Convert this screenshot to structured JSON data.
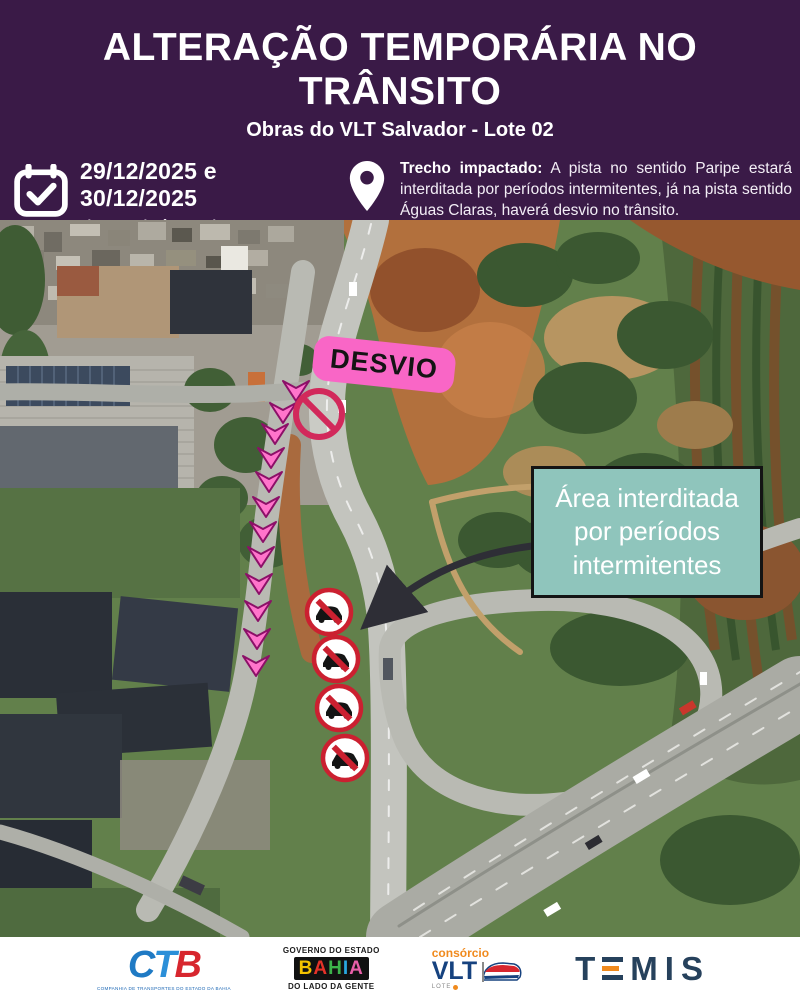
{
  "header": {
    "title": "ALTERAÇÃO TEMPORÁRIA NO TRÂNSITO",
    "subtitle": "Obras do VLT Salvador - Lote 02"
  },
  "info": {
    "dates": "29/12/2025 e 30/12/2025",
    "hours": "das 23h às 05h",
    "lead_bold": "Trecho impactado:",
    "body": " A pista no sentido Paripe estará interditada por períodos intermitentes, já na pista sentido Águas Claras, haverá desvio no trânsito.",
    "emphasis": "Áreas impactadas estarão devidamente sinalizadas.",
    "warning": "OBEDEÇA A SINALIZAÇÃO E EVITE ACIDENTES!!",
    "calendar_icon": "calendar-check-icon",
    "pin_icon": "location-pin-icon"
  },
  "map": {
    "desvio_label": "DESVIO",
    "callout_text": "Área interditada por períodos intermitentes",
    "chevrons": [
      [
        296,
        171
      ],
      [
        283,
        193
      ],
      [
        275,
        214
      ],
      [
        271,
        238
      ],
      [
        269,
        262
      ],
      [
        266,
        287
      ],
      [
        263,
        312
      ],
      [
        261,
        337
      ],
      [
        259,
        364
      ],
      [
        258,
        391
      ],
      [
        257,
        419
      ],
      [
        256,
        446
      ]
    ],
    "no_entry_sign": {
      "x": 319,
      "y": 194,
      "r": 23
    },
    "no_car_signs": [
      [
        329,
        392
      ],
      [
        336,
        439
      ],
      [
        339,
        488
      ],
      [
        345,
        538
      ]
    ],
    "colors": {
      "pink": "#f966c6",
      "teal": "#8fc5bc",
      "warning_yellow": "#f2b33e",
      "purple": "#3a1a47",
      "chevron": "#ff74cb",
      "chevron_outline": "#8c1068",
      "no_entry_red": "#d2295b",
      "sign_ring_red": "#cb2030",
      "arrow_black": "#2e2e36"
    }
  },
  "footer": {
    "ctb": {
      "letters": [
        "C",
        "T",
        "B"
      ],
      "caption": "COMPANHIA DE TRANSPORTES DO ESTADO DA BAHIA"
    },
    "bahia": {
      "top": "GOVERNO DO ESTADO",
      "letters": [
        "B",
        "A",
        "H",
        "I",
        "A"
      ],
      "bottom": "DO LADO DA GENTE"
    },
    "vlt": {
      "top": "consórcio",
      "name": "VLT",
      "lote": "LOTE"
    },
    "temis": {
      "letters": [
        "T",
        "M",
        "I",
        "S"
      ]
    }
  }
}
